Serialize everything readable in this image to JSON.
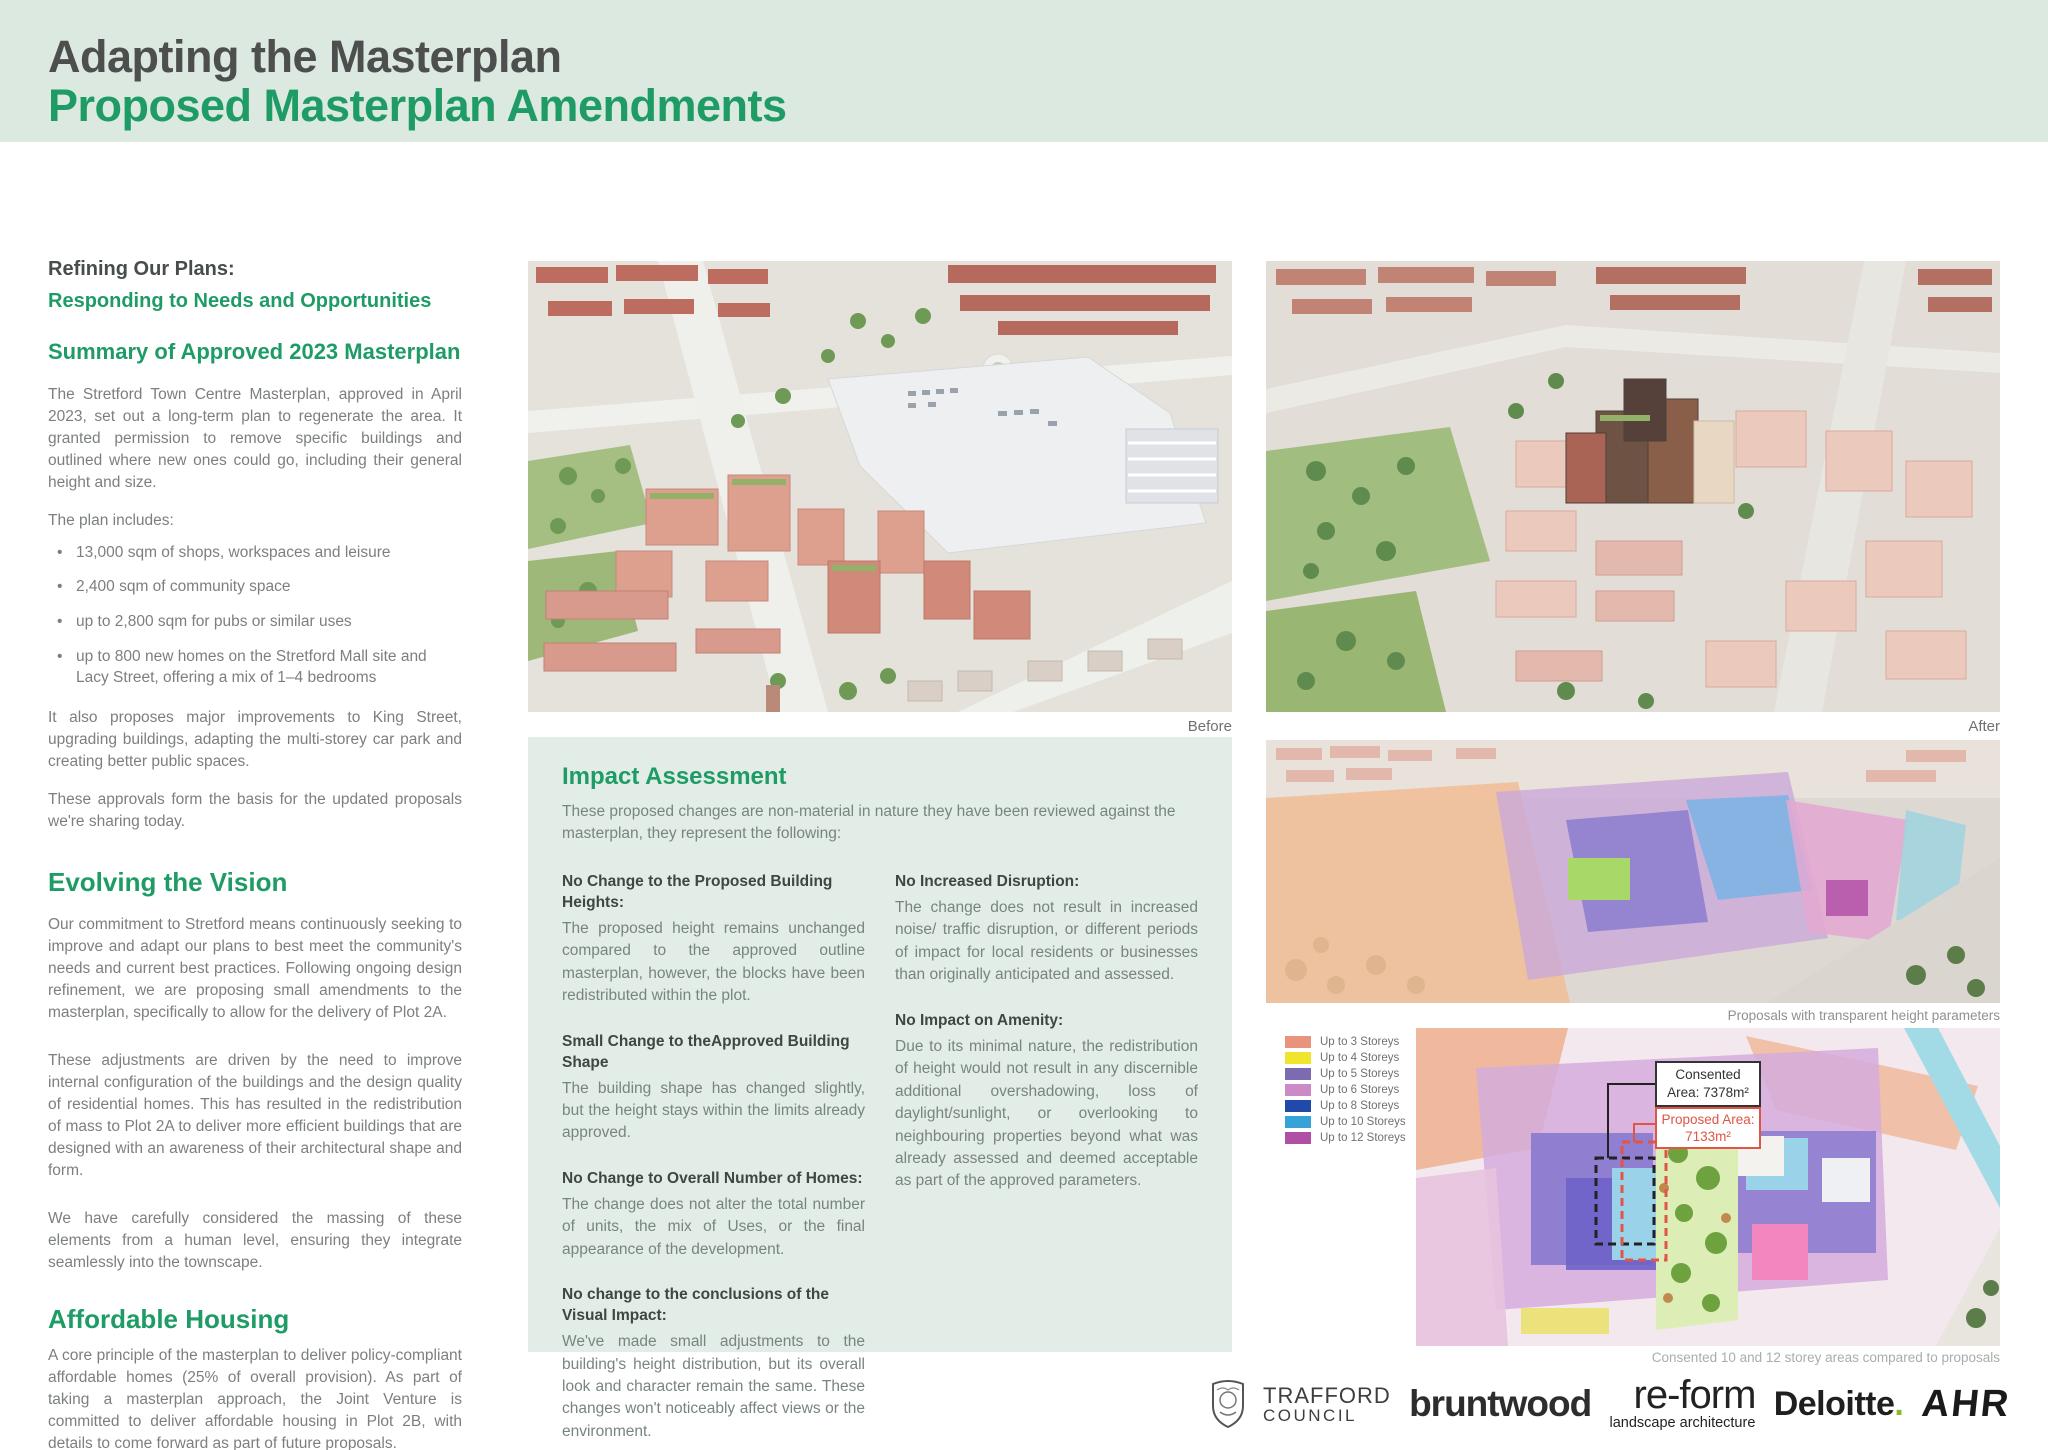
{
  "header": {
    "title": "Adapting the Masterplan",
    "subtitle": "Proposed Masterplan Amendments"
  },
  "left_column": {
    "intro_heading_line1": "Refining Our Plans:",
    "intro_heading_line2": "Responding to Needs and Opportunities",
    "summary_heading": "Summary of Approved 2023 Masterplan",
    "summary_para": "The Stretford Town Centre Masterplan, approved in April 2023, set out a long-term plan to regenerate the area. It granted permission to remove specific buildings and outlined where new ones could go, including their general height and size.",
    "plan_includes_label": "The plan includes:",
    "bullets": [
      "13,000 sqm of shops, workspaces and leisure",
      "2,400 sqm of community space",
      "up to 2,800 sqm for pubs or similar uses",
      "up to 800 new homes on the Stretford Mall site and Lacy Street, offering a mix of 1–4 bedrooms"
    ],
    "para_king_street": "It also proposes major improvements to King Street, upgrading buildings, adapting the multi-storey car park and creating better public spaces.",
    "para_approvals": "These approvals form the basis for the updated proposals we're sharing today.",
    "evolving_heading": "Evolving the Vision",
    "evolving_para1": "Our commitment to Stretford means continuously seeking to improve and adapt our plans to best meet the community's needs and current best practices. Following ongoing design refinement, we are proposing small amendments to the masterplan, specifically to allow for the delivery of Plot 2A.",
    "evolving_para2": "These adjustments are driven by the need to improve internal configuration of the buildings and the design quality of residential homes. This has resulted in the redistribution of mass to Plot 2A to deliver more efficient buildings that are designed with an awareness of their architectural shape and form.",
    "evolving_para3": "We have carefully considered the massing of these elements from a human level, ensuring they integrate seamlessly into the townscape.",
    "affordable_heading": "Affordable Housing",
    "affordable_para": "A core principle of the masterplan to deliver policy-compliant affordable homes (25% of overall provision). As part of taking a masterplan approach, the Joint Venture is committed to deliver affordable housing in Plot 2B, with details to come forward as part of future proposals."
  },
  "impact_assessment": {
    "title": "Impact Assessment",
    "intro": "These proposed changes are non-material in nature they have been reviewed against the masterplan, they represent the following:",
    "items_left": [
      {
        "heading": "No Change to the Proposed Building Heights:",
        "body": "The proposed height remains unchanged compared to the approved outline masterplan, however, the blocks have been redistributed within the plot."
      },
      {
        "heading": "Small Change to theApproved Building Shape",
        "body": "The building shape has changed slightly, but the height stays within the limits already approved."
      },
      {
        "heading": "No Change to Overall Number of Homes:",
        "body": "The change does not alter the total number of units, the mix of Uses, or the final appearance of the development."
      },
      {
        "heading": "No change to the conclusions of the Visual Impact:",
        "body": "We've made small adjustments to the building's height distribution, but its overall look and character remain the same. These changes won't noticeably affect views or the environment."
      }
    ],
    "items_right": [
      {
        "heading": "No Increased Disruption:",
        "body": "The change does not result in increased noise/ traffic disruption, or different periods of impact for local residents or businesses than originally anticipated and assessed."
      },
      {
        "heading": "No Impact on Amenity:",
        "body": "Due to its minimal nature, the redistribution of height would not result in any discernible additional overshadowing, loss of daylight/sunlight, or overlooking to neighbouring properties beyond what was already assessed and deemed acceptable as part of the approved parameters."
      }
    ]
  },
  "captions": {
    "before": "Before",
    "after": "After",
    "parameters": "Proposals with transparent height parameters",
    "map": "Consented 10 and 12 storey areas compared to proposals"
  },
  "map_annotations": {
    "consented_line1": "Consented",
    "consented_line2": "Area: 7378m²",
    "proposed_line1": "Proposed Area:",
    "proposed_line2": "7133m²"
  },
  "legend": {
    "items": [
      {
        "label": "Up to 3 Storeys",
        "color": "#E8937B"
      },
      {
        "label": "Up to 4 Storeys",
        "color": "#EFE52E"
      },
      {
        "label": "Up to 5 Storeys",
        "color": "#7C6BB0"
      },
      {
        "label": "Up to 6 Storeys",
        "color": "#CC8BC6"
      },
      {
        "label": "Up to 8 Storeys",
        "color": "#2149A9"
      },
      {
        "label": "Up to 10 Storeys",
        "color": "#35A3D7"
      },
      {
        "label": "Up to 12 Storeys",
        "color": "#AF4FA5"
      }
    ]
  },
  "footer": {
    "trafford_line1": "TRAFFORD",
    "trafford_line2": "COUNCIL",
    "bruntwood": "bruntwood",
    "reform": "re-form",
    "reform_sub": "landscape architecture",
    "deloitte": "Deloitte",
    "deloitte_dot": ".",
    "ahr": "AHR"
  },
  "colors": {
    "accent_green": "#1f9c66",
    "header_bg": "#dce9e1",
    "impact_bg": "#e3ede7",
    "deloitte_green": "#86BC25"
  }
}
